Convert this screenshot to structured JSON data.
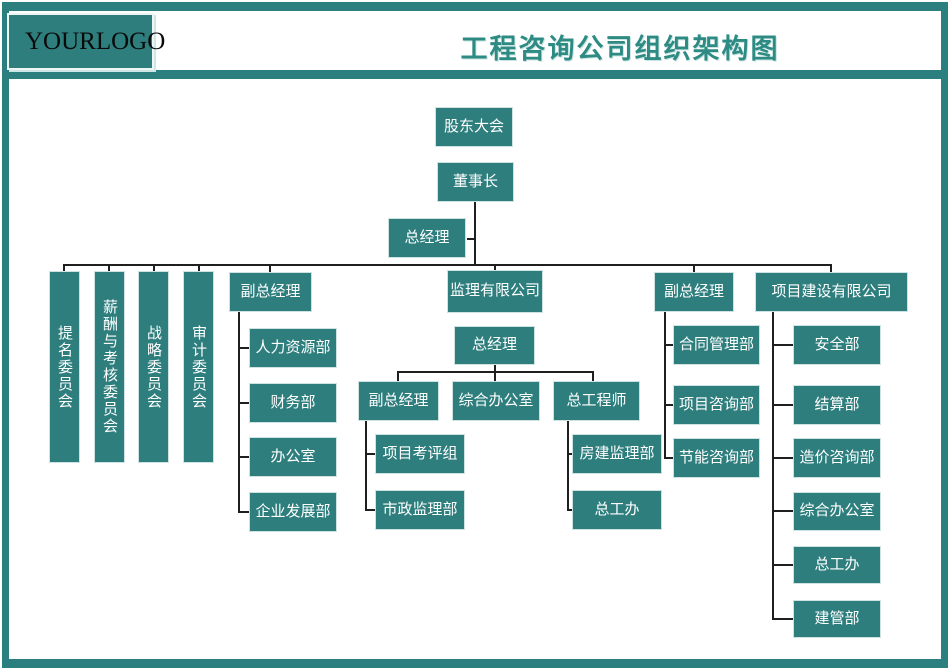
{
  "header": {
    "logo_left": "YOUR",
    "logo_right": "LOGO",
    "title": "工程咨询公司组织架构图"
  },
  "colors": {
    "frame_teal": "#2b7f7f",
    "node_fill": "#2e7e7e",
    "node_border": "#cfe2e2",
    "node_text": "#ffffff",
    "title_text": "#2e8b84",
    "connector": "#1f1f1f"
  },
  "chart": {
    "type": "org-chart",
    "nodes": {
      "shareholders": {
        "label": "股东大会",
        "parent": null
      },
      "chairman": {
        "label": "董事长",
        "parent": "shareholders"
      },
      "gm": {
        "label": "总经理",
        "parent": "chairman"
      },
      "committee_nomination": {
        "label": "提名委员会",
        "parent": "chairman"
      },
      "committee_compensation": {
        "label": "薪酬与考核委员会",
        "parent": "chairman"
      },
      "committee_strategy": {
        "label": "战略委员会",
        "parent": "chairman"
      },
      "committee_audit": {
        "label": "审计委员会",
        "parent": "chairman"
      },
      "dgm1": {
        "label": "副总经理",
        "parent": "chairman"
      },
      "hr_dept": {
        "label": "人力资源部",
        "parent": "dgm1"
      },
      "finance_dept": {
        "label": "财务部",
        "parent": "dgm1"
      },
      "office": {
        "label": "办公室",
        "parent": "dgm1"
      },
      "enterprise_dev_dept": {
        "label": "企业发展部",
        "parent": "dgm1"
      },
      "supervision_co": {
        "label": "监理有限公司",
        "parent": "chairman"
      },
      "sup_gm": {
        "label": "总经理",
        "parent": "supervision_co"
      },
      "sup_dgm": {
        "label": "副总经理",
        "parent": "sup_gm"
      },
      "sup_admin_office": {
        "label": "综合办公室",
        "parent": "sup_gm"
      },
      "chief_engineer": {
        "label": "总工程师",
        "parent": "sup_gm"
      },
      "project_eval_group": {
        "label": "项目考评组",
        "parent": "sup_dgm"
      },
      "municipal_supervision_dept": {
        "label": "市政监理部",
        "parent": "sup_dgm"
      },
      "housing_supervision_dept": {
        "label": "房建监理部",
        "parent": "chief_engineer"
      },
      "chief_eng_office_sup": {
        "label": "总工办",
        "parent": "chief_engineer"
      },
      "dgm2": {
        "label": "副总经理",
        "parent": "chairman"
      },
      "contract_mgmt_dept": {
        "label": "合同管理部",
        "parent": "dgm2"
      },
      "project_consulting_dept": {
        "label": "项目咨询部",
        "parent": "dgm2"
      },
      "energy_consulting_dept": {
        "label": "节能咨询部",
        "parent": "dgm2"
      },
      "project_construction_co": {
        "label": "项目建设有限公司",
        "parent": "chairman"
      },
      "safety_dept": {
        "label": "安全部",
        "parent": "project_construction_co"
      },
      "settlement_dept": {
        "label": "结算部",
        "parent": "project_construction_co"
      },
      "cost_consulting_dept": {
        "label": "造价咨询部",
        "parent": "project_construction_co"
      },
      "admin_office_pc": {
        "label": "综合办公室",
        "parent": "project_construction_co"
      },
      "chief_eng_office_pc": {
        "label": "总工办",
        "parent": "project_construction_co"
      },
      "construction_mgmt_dept": {
        "label": "建管部",
        "parent": "project_construction_co"
      }
    }
  }
}
